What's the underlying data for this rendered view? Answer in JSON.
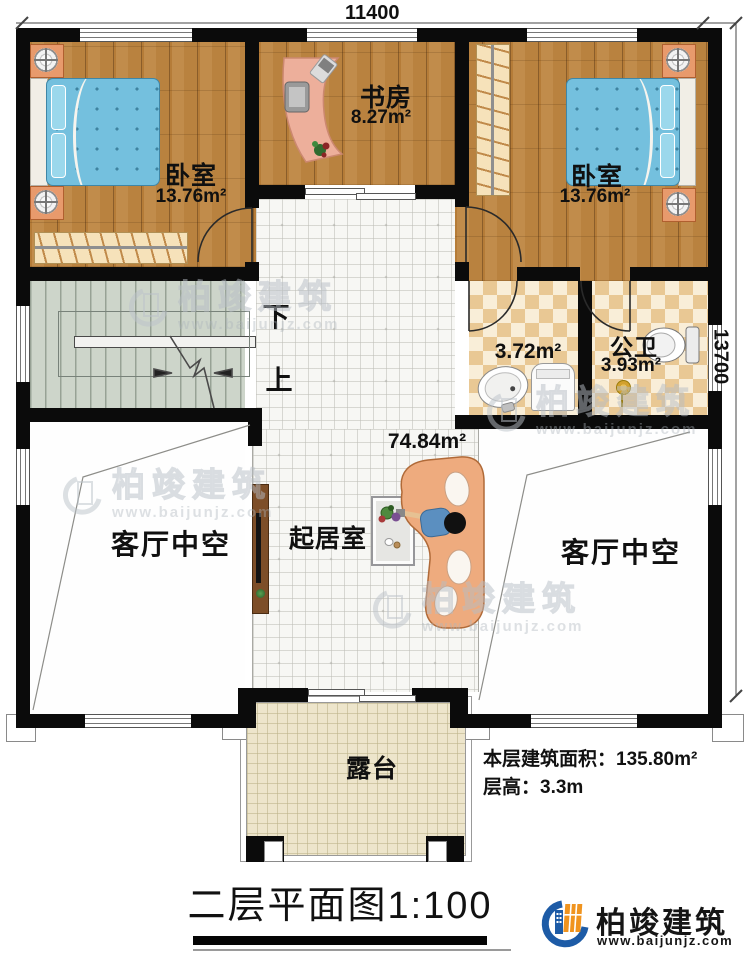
{
  "dimensions": {
    "width_top": "11400",
    "height_right": "13700"
  },
  "rooms": {
    "bedroom_left": {
      "name": "卧室",
      "area": "13.76m²"
    },
    "study": {
      "name": "书房",
      "area": "8.27m²"
    },
    "bedroom_right": {
      "name": "卧室",
      "area": "13.76m²"
    },
    "bath_small": {
      "area": "3.72m²"
    },
    "bath_public": {
      "name": "公卫",
      "area": "3.93m²"
    },
    "living": {
      "name": "起居室",
      "area": "74.84m²"
    },
    "void_left": {
      "name": "客厅中空"
    },
    "void_right": {
      "name": "客厅中空"
    },
    "terrace": {
      "name": "露台"
    }
  },
  "stairs": {
    "down_label": "下",
    "up_label": "上"
  },
  "annotations": {
    "floor_area": "本层建筑面积：135.80m²",
    "floor_height": "层高：3.3m"
  },
  "title": {
    "text": "二层平面图1:100"
  },
  "brand": {
    "name": "柏竣建筑",
    "website": "www.baijunjz.com"
  },
  "watermark": {
    "name": "柏竣建筑",
    "website": "www.baijunjz.com"
  },
  "colors": {
    "wall": "#0b0b0b",
    "wood": "#bb8342",
    "tile_living": "#f7f7f4",
    "tile_bath": "#e9c894",
    "stairs": "#cdd5ca",
    "terrace": "#ede5cb",
    "accent_blue": "#1d5ba6",
    "accent_orange": "#f0941f",
    "bed_blue": "#74c0de"
  }
}
